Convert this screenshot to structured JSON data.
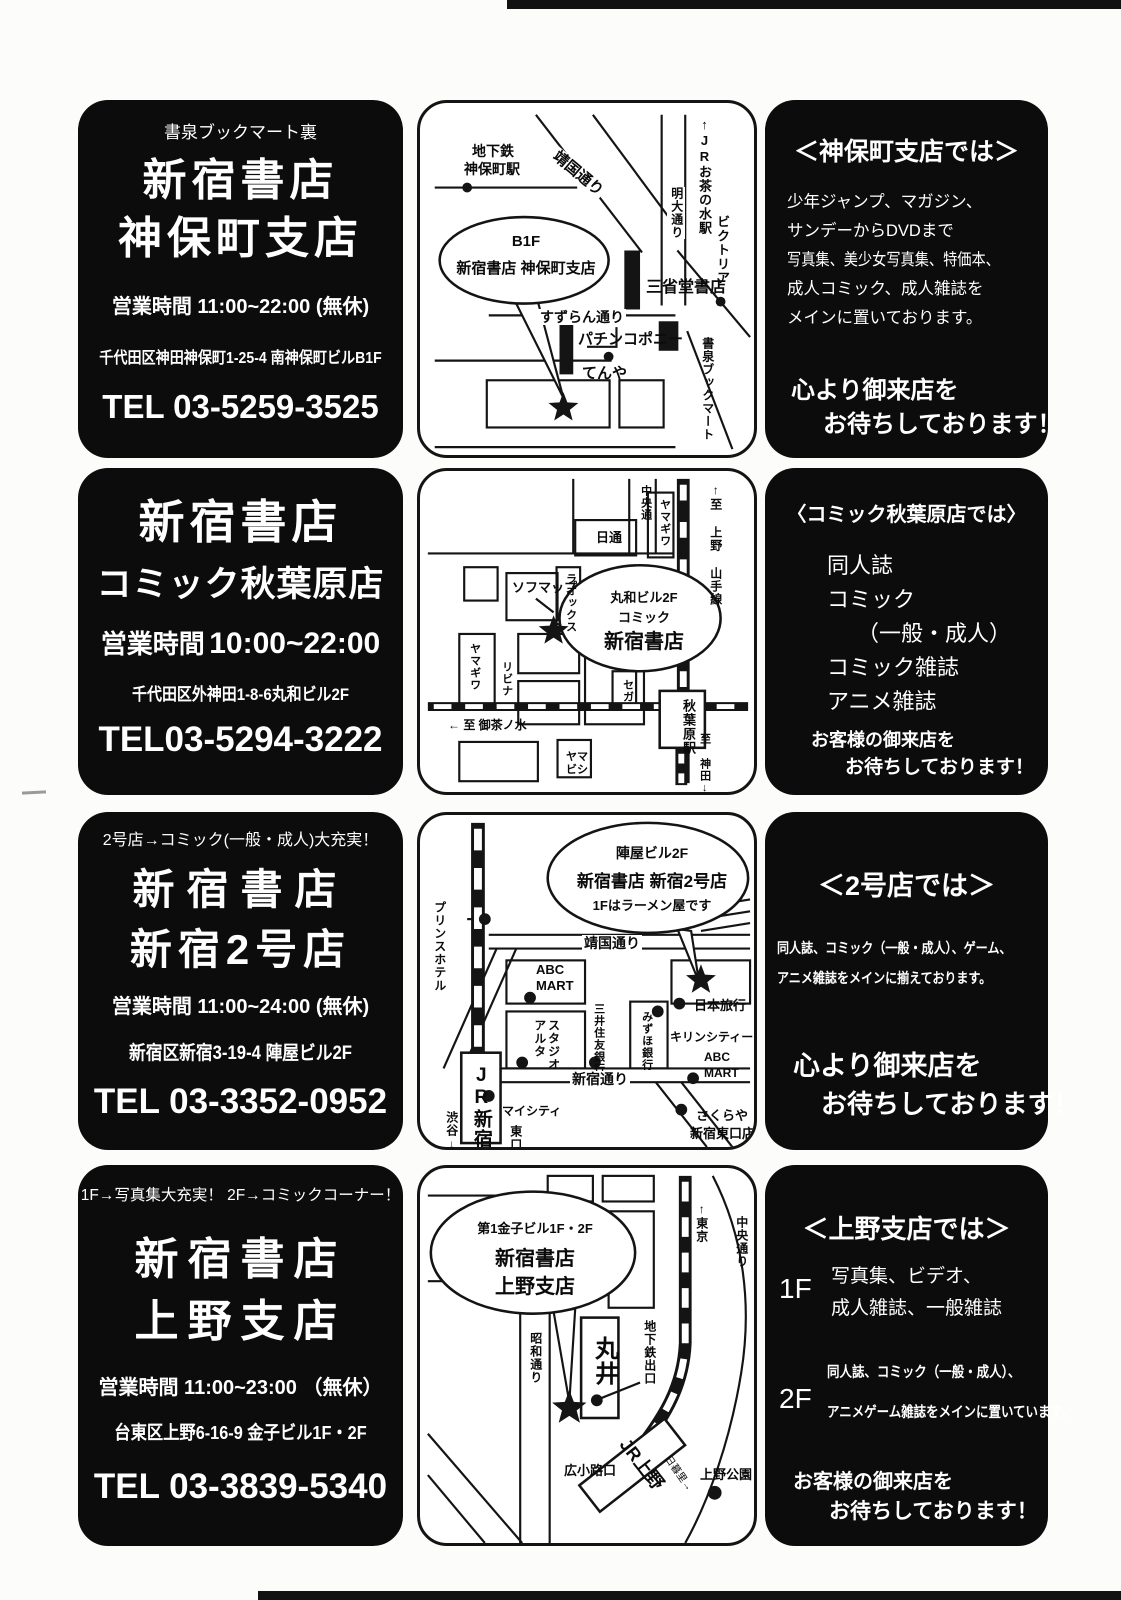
{
  "stores": [
    {
      "info": {
        "note": "書泉ブックマート裏",
        "name1": "新宿書店",
        "name2": "神保町支店",
        "hours_label": "営業時間",
        "hours_value": "11:00~22:00",
        "hours_note": "(無休)",
        "address": "千代田区神田神保町1-25-4 南神保町ビルB1F",
        "tel": "TEL 03-5259-3525"
      },
      "map": {
        "balloon1": "B1F",
        "balloon2": "新宿書店 神保町支店",
        "labels": {
          "subway1": "地下鉄",
          "subway2": "神保町駅",
          "yasukuni": "靖国通り",
          "jr_ochanomizu": "↑JRお茶の水駅",
          "meidai": "明大通り",
          "victoria": "ビクトリア",
          "sanseido": "三省堂書店",
          "suzuran": "すずらん通り",
          "pachinko": "パチンコポニー",
          "tenya": "てんや",
          "shosen": "書泉ブックマート"
        }
      },
      "promo": {
        "title": "＜神保町支店では＞",
        "lines": [
          "少年ジャンプ、マガジン、",
          "サンデーからDVDまで",
          "写真集、美少女写真集、特価本、",
          "成人コミック、成人雑誌を",
          "メインに置いております。"
        ],
        "closing1": "心より御来店を",
        "closing2": "お待ちしております！"
      }
    },
    {
      "info": {
        "name1": "新宿書店",
        "name2": "コミック秋葉原店",
        "hours_label": "営業時間",
        "hours_value": "10:00~22:00",
        "address": "千代田区外神田1-8-6丸和ビル2F",
        "tel": "TEL03-5294-3222"
      },
      "map": {
        "balloon1": "丸和ビル2F",
        "balloon2": "コミック",
        "balloon3": "新宿書店",
        "labels": {
          "chuo": "中央通",
          "yamagiwa_r": "ヤマギワ",
          "ue_ueno": "↑至 上野",
          "yamanote": "山手線",
          "nittsu": "日通",
          "sofmap": "ソフマップ",
          "laox": "ラオックス",
          "yamagiwa_l": "ヤマギワ",
          "livina": "リビナ",
          "sega": "セガ",
          "akihabara_sta": "秋葉原駅",
          "ochanomizu": "← 至 御茶ノ水",
          "yamabishi": "ヤマビシ",
          "kanda": "至 神田↓"
        }
      },
      "promo": {
        "title": "〈コミック秋葉原店では〉",
        "items": [
          "同人誌",
          "コミック",
          "（一般・成人）",
          "コミック雑誌",
          "アニメ雑誌"
        ],
        "closing1": "お客様の御来店を",
        "closing2": "お待ちしております！"
      }
    },
    {
      "info": {
        "note": "2号店→コミック(一般・成人)大充実！",
        "name1": "新宿書店",
        "name2": "新宿2号店",
        "hours_label": "営業時間",
        "hours_value": "11:00~24:00",
        "hours_note": "(無休)",
        "address": "新宿区新宿3-19-4 陣屋ビル2F",
        "tel": "TEL 03-3352-0952"
      },
      "map": {
        "balloon1": "陣屋ビル2F",
        "balloon2": "新宿書店 新宿2号店",
        "balloon3": "1Fはラーメン屋です",
        "labels": {
          "prince": "プリンスホテル",
          "yasukuni": "靖国通り",
          "abc1a": "ABC",
          "abc1b": "MART",
          "mitsui": "三井住友銀行",
          "studio": "スタジオ",
          "alta": "アルタ",
          "mizuho": "みずほ銀行",
          "kirin": "キリンシティー",
          "nihon": "日本旅行",
          "shinjuku_dori": "新宿通り",
          "jr_shinjuku": "JR新宿",
          "mycity": "マイシティ",
          "higashi": "東口",
          "shibuya": "渋谷↓",
          "abc2a": "ABC",
          "abc2b": "MART",
          "sakuraya1": "さくらや",
          "sakuraya2": "新宿東口店"
        }
      },
      "promo": {
        "title": "＜2号店では＞",
        "lines": [
          "同人誌、コミック（一般・成人）、ゲーム、",
          "アニメ雑誌をメインに揃えております。"
        ],
        "closing1": "心より御来店を",
        "closing2": "お待ちしております！"
      }
    },
    {
      "info": {
        "note": "1F→写真集大充実！ 2F→コミックコーナー！",
        "name1": "新宿書店",
        "name2": "上野支店",
        "hours_label": "営業時間",
        "hours_value": "11:00~23:00",
        "hours_note": "（無休）",
        "address": "台東区上野6-16-9 金子ビル1F・2F",
        "tel": "TEL 03-3839-5340"
      },
      "map": {
        "balloon1": "第1金子ビル1F・2F",
        "balloon2": "新宿書店",
        "balloon3": "上野支店",
        "labels": {
          "tokyo": "↑東京",
          "chuo": "中央通り",
          "showa": "昭和通り",
          "marui": "丸井",
          "chikatetsu": "地下鉄出口",
          "hirokoji": "広小路口",
          "jr_ueno": "JR上野",
          "nippori": "日暮里→",
          "ueno_park": "上野公園"
        }
      },
      "promo": {
        "title": "＜上野支店では＞",
        "floor1_label": "1F",
        "floor1_lines": [
          "写真集、ビデオ、",
          "成人雑誌、一般雑誌"
        ],
        "floor2_label": "2F",
        "floor2_lines": [
          "同人誌、コミック（一般・成人）、",
          "アニメゲーム雑誌をメインに置いています。"
        ],
        "closing1": "お客様の御来店を",
        "closing2": "お待ちしております！"
      }
    }
  ]
}
